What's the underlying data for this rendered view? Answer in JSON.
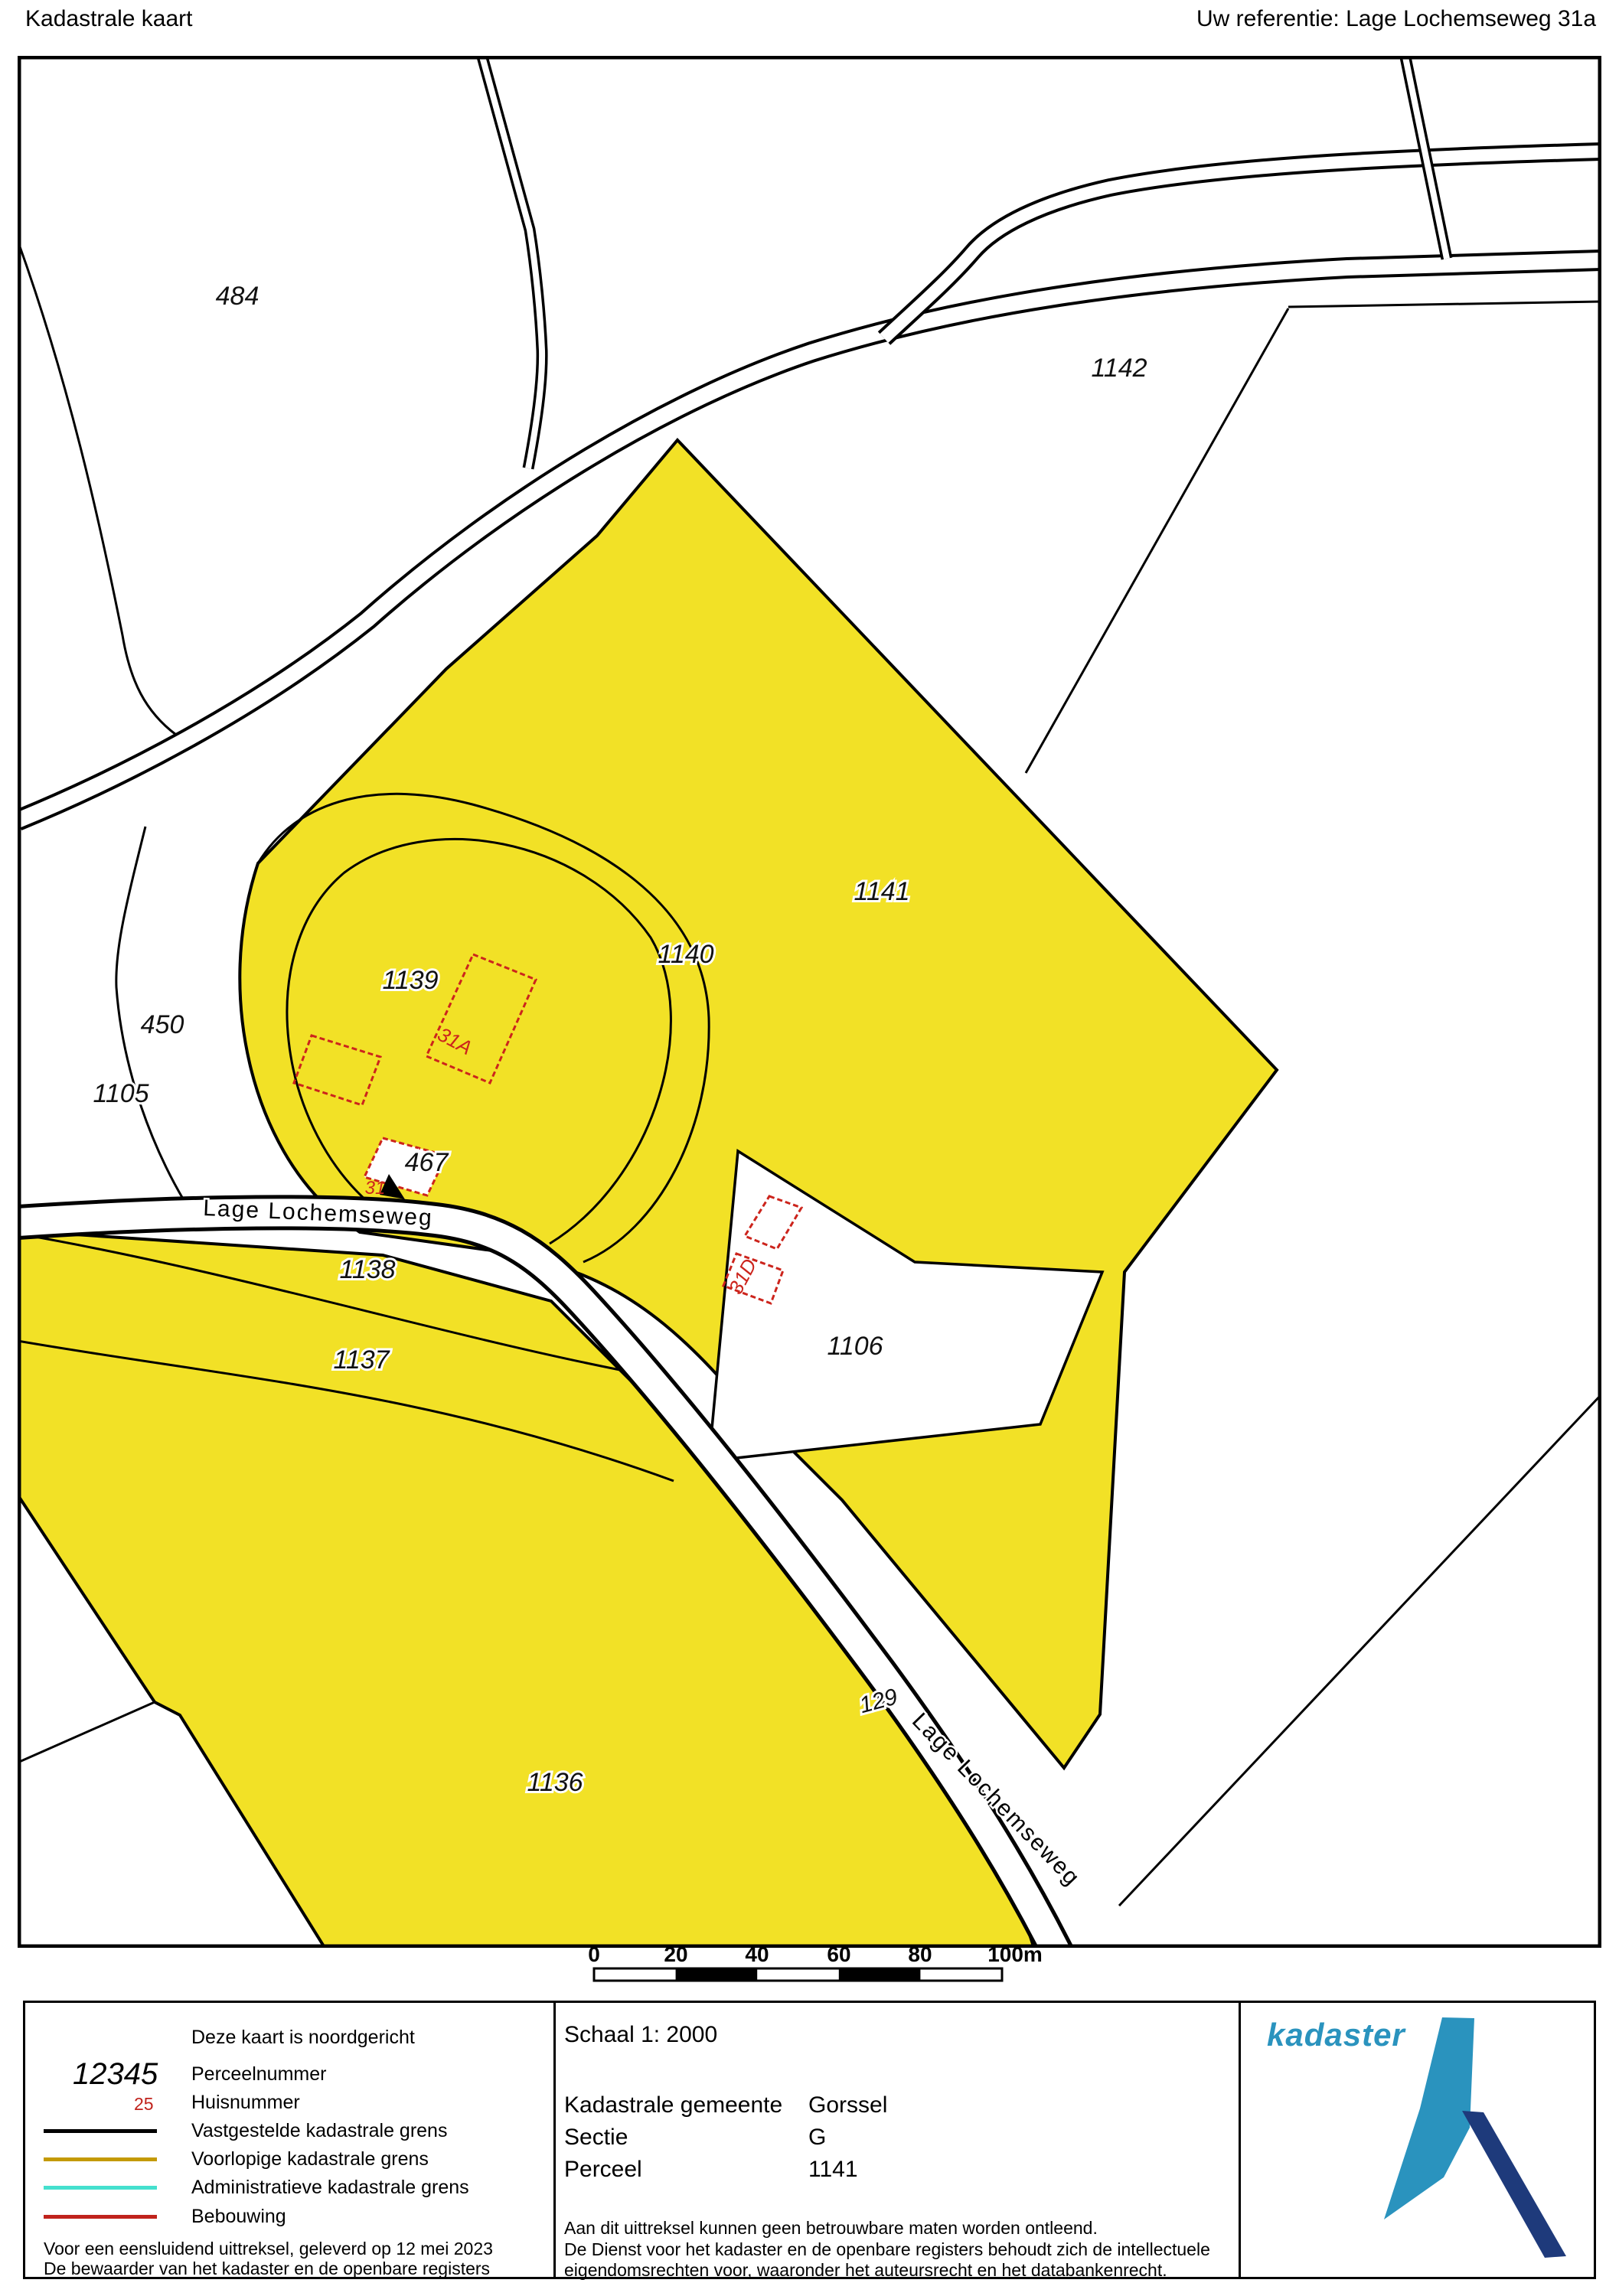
{
  "header": {
    "title": "Kadastrale kaart",
    "reference": "Uw referentie: Lage Lochemseweg 31a"
  },
  "map": {
    "colors": {
      "parcel_highlight": "#F2E126",
      "boundary": "#000000",
      "building_outline": "#CC241C",
      "house_number": "#CC241C"
    },
    "parcel_labels": [
      {
        "text": "484"
      },
      {
        "text": "1142"
      },
      {
        "text": "1141"
      },
      {
        "text": "1140"
      },
      {
        "text": "1139"
      },
      {
        "text": "450"
      },
      {
        "text": "1105"
      },
      {
        "text": "467"
      },
      {
        "text": "1138"
      },
      {
        "text": "1137"
      },
      {
        "text": "1106"
      },
      {
        "text": "1136"
      },
      {
        "text": "129"
      }
    ],
    "house_numbers": [
      {
        "text": "31A"
      },
      {
        "text": "31"
      },
      {
        "text": "31D"
      }
    ],
    "road_labels": [
      {
        "text": "Lage Lochemseweg"
      },
      {
        "text": "Lage Lochemseweg"
      }
    ]
  },
  "scale_bar": {
    "labels": [
      "0",
      "20",
      "40",
      "60",
      "80",
      "100m"
    ]
  },
  "legend": {
    "north_note": "Deze kaart is noordgericht",
    "items": [
      {
        "symbol": "12345",
        "label": "Perceelnummer"
      },
      {
        "symbol": "25",
        "label": "Huisnummer"
      },
      {
        "color": "#000000",
        "label": "Vastgestelde kadastrale grens"
      },
      {
        "color": "#C49A02",
        "label": "Voorlopige kadastrale grens"
      },
      {
        "color": "#45E0CE",
        "label": "Administratieve kadastrale grens"
      },
      {
        "color": "#C0231C",
        "label": "Bebouwing"
      }
    ],
    "footer_lines": [
      "Voor een eensluidend uittreksel, geleverd op 12 mei 2023",
      "De bewaarder van het kadaster en de openbare registers"
    ]
  },
  "info": {
    "scale": "Schaal 1: 2000",
    "rows": [
      {
        "label": "Kadastrale gemeente",
        "value": "Gorssel"
      },
      {
        "label": "Sectie",
        "value": "G"
      },
      {
        "label": "Perceel",
        "value": "1141"
      }
    ],
    "disclaimer_lines": [
      "Aan dit uittreksel kunnen geen betrouwbare maten worden ontleend.",
      "De Dienst voor het kadaster en de openbare registers behoudt zich de intellectuele",
      "eigendomsrechten voor, waaronder het auteursrecht en het databankenrecht."
    ]
  },
  "logo": {
    "text": "kadaster",
    "colors": {
      "light_blue": "#2A93BE",
      "dark_blue": "#1E3A7B"
    }
  }
}
